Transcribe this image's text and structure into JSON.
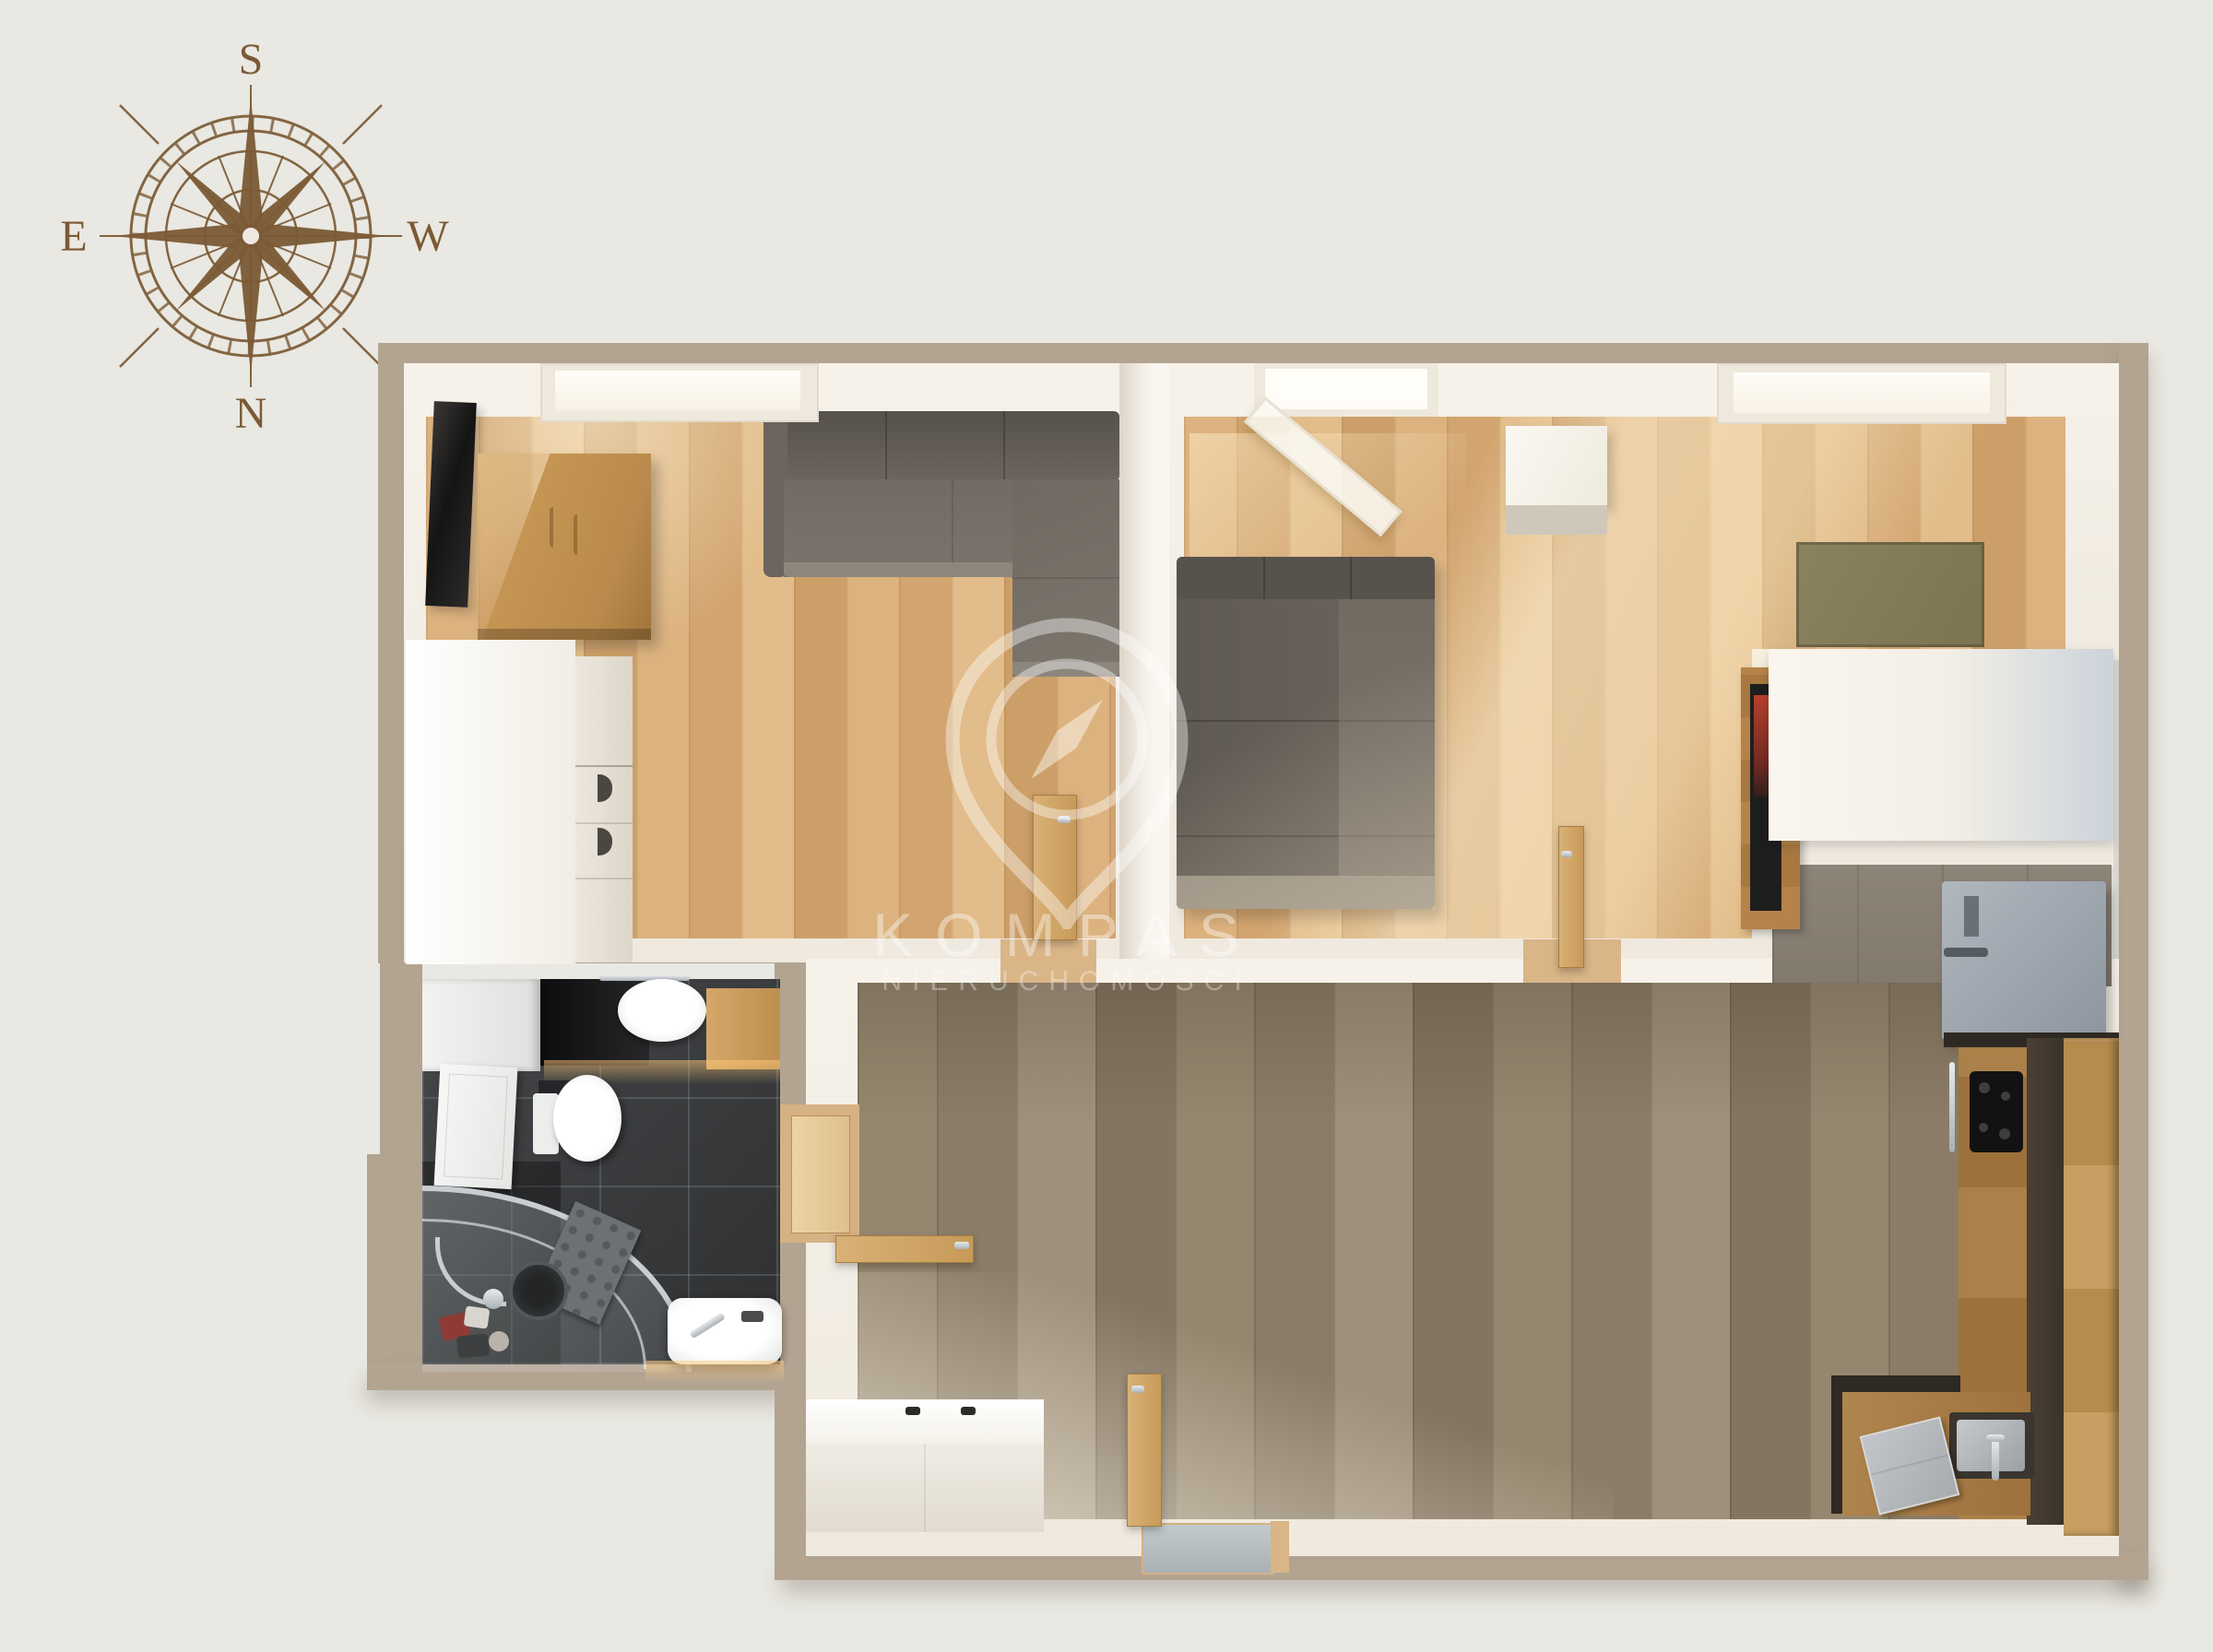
{
  "compass": {
    "top": "S",
    "right": "W",
    "bottom": "N",
    "left": "E"
  },
  "watermark": {
    "brand": "KOMPAS",
    "subtitle": "NIERUCHOMOŚCI"
  },
  "icons": {
    "compass_rose": "compass-rose-icon",
    "watermark_pin": "map-pin-compass-icon"
  },
  "palette": {
    "background": "#e9e8e2",
    "wall": "#b3a492",
    "wall_face": "#f3efe7",
    "floor_wood_light": "#d7ab79",
    "floor_wood_gray": "#8f8170",
    "bathroom_tile": "#3e4042",
    "sofa_gray": "#6e6860",
    "kitchen_wood": "#a67a46",
    "cabinet_dark": "#463c31",
    "fridge_gray": "#9aa2ab",
    "rug_olive": "#837a58",
    "doormat_gray": "#b7bec2",
    "compass_brown": "#7b5a35",
    "watermark_white": "rgba(255,255,255,0.38)"
  }
}
